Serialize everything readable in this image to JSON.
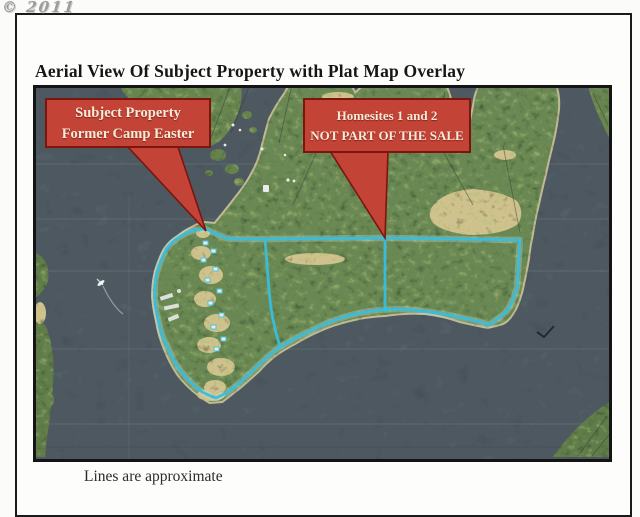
{
  "watermark": "© 2011",
  "document": {
    "title": "Aerial View Of Subject Property with Plat Map Overlay",
    "caption": "Lines are approximate"
  },
  "callouts": {
    "subject": {
      "line1": "Subject Property",
      "line2": "Former Camp Easter"
    },
    "homesites": {
      "line1": "Homesites 1 and 2",
      "line2": "NOT PART OF THE SALE"
    }
  },
  "colors": {
    "boundary_line": "#38bede",
    "callout_fill": "#c34337",
    "callout_border": "#7c150d",
    "callout_text": "#f5ecd8"
  }
}
